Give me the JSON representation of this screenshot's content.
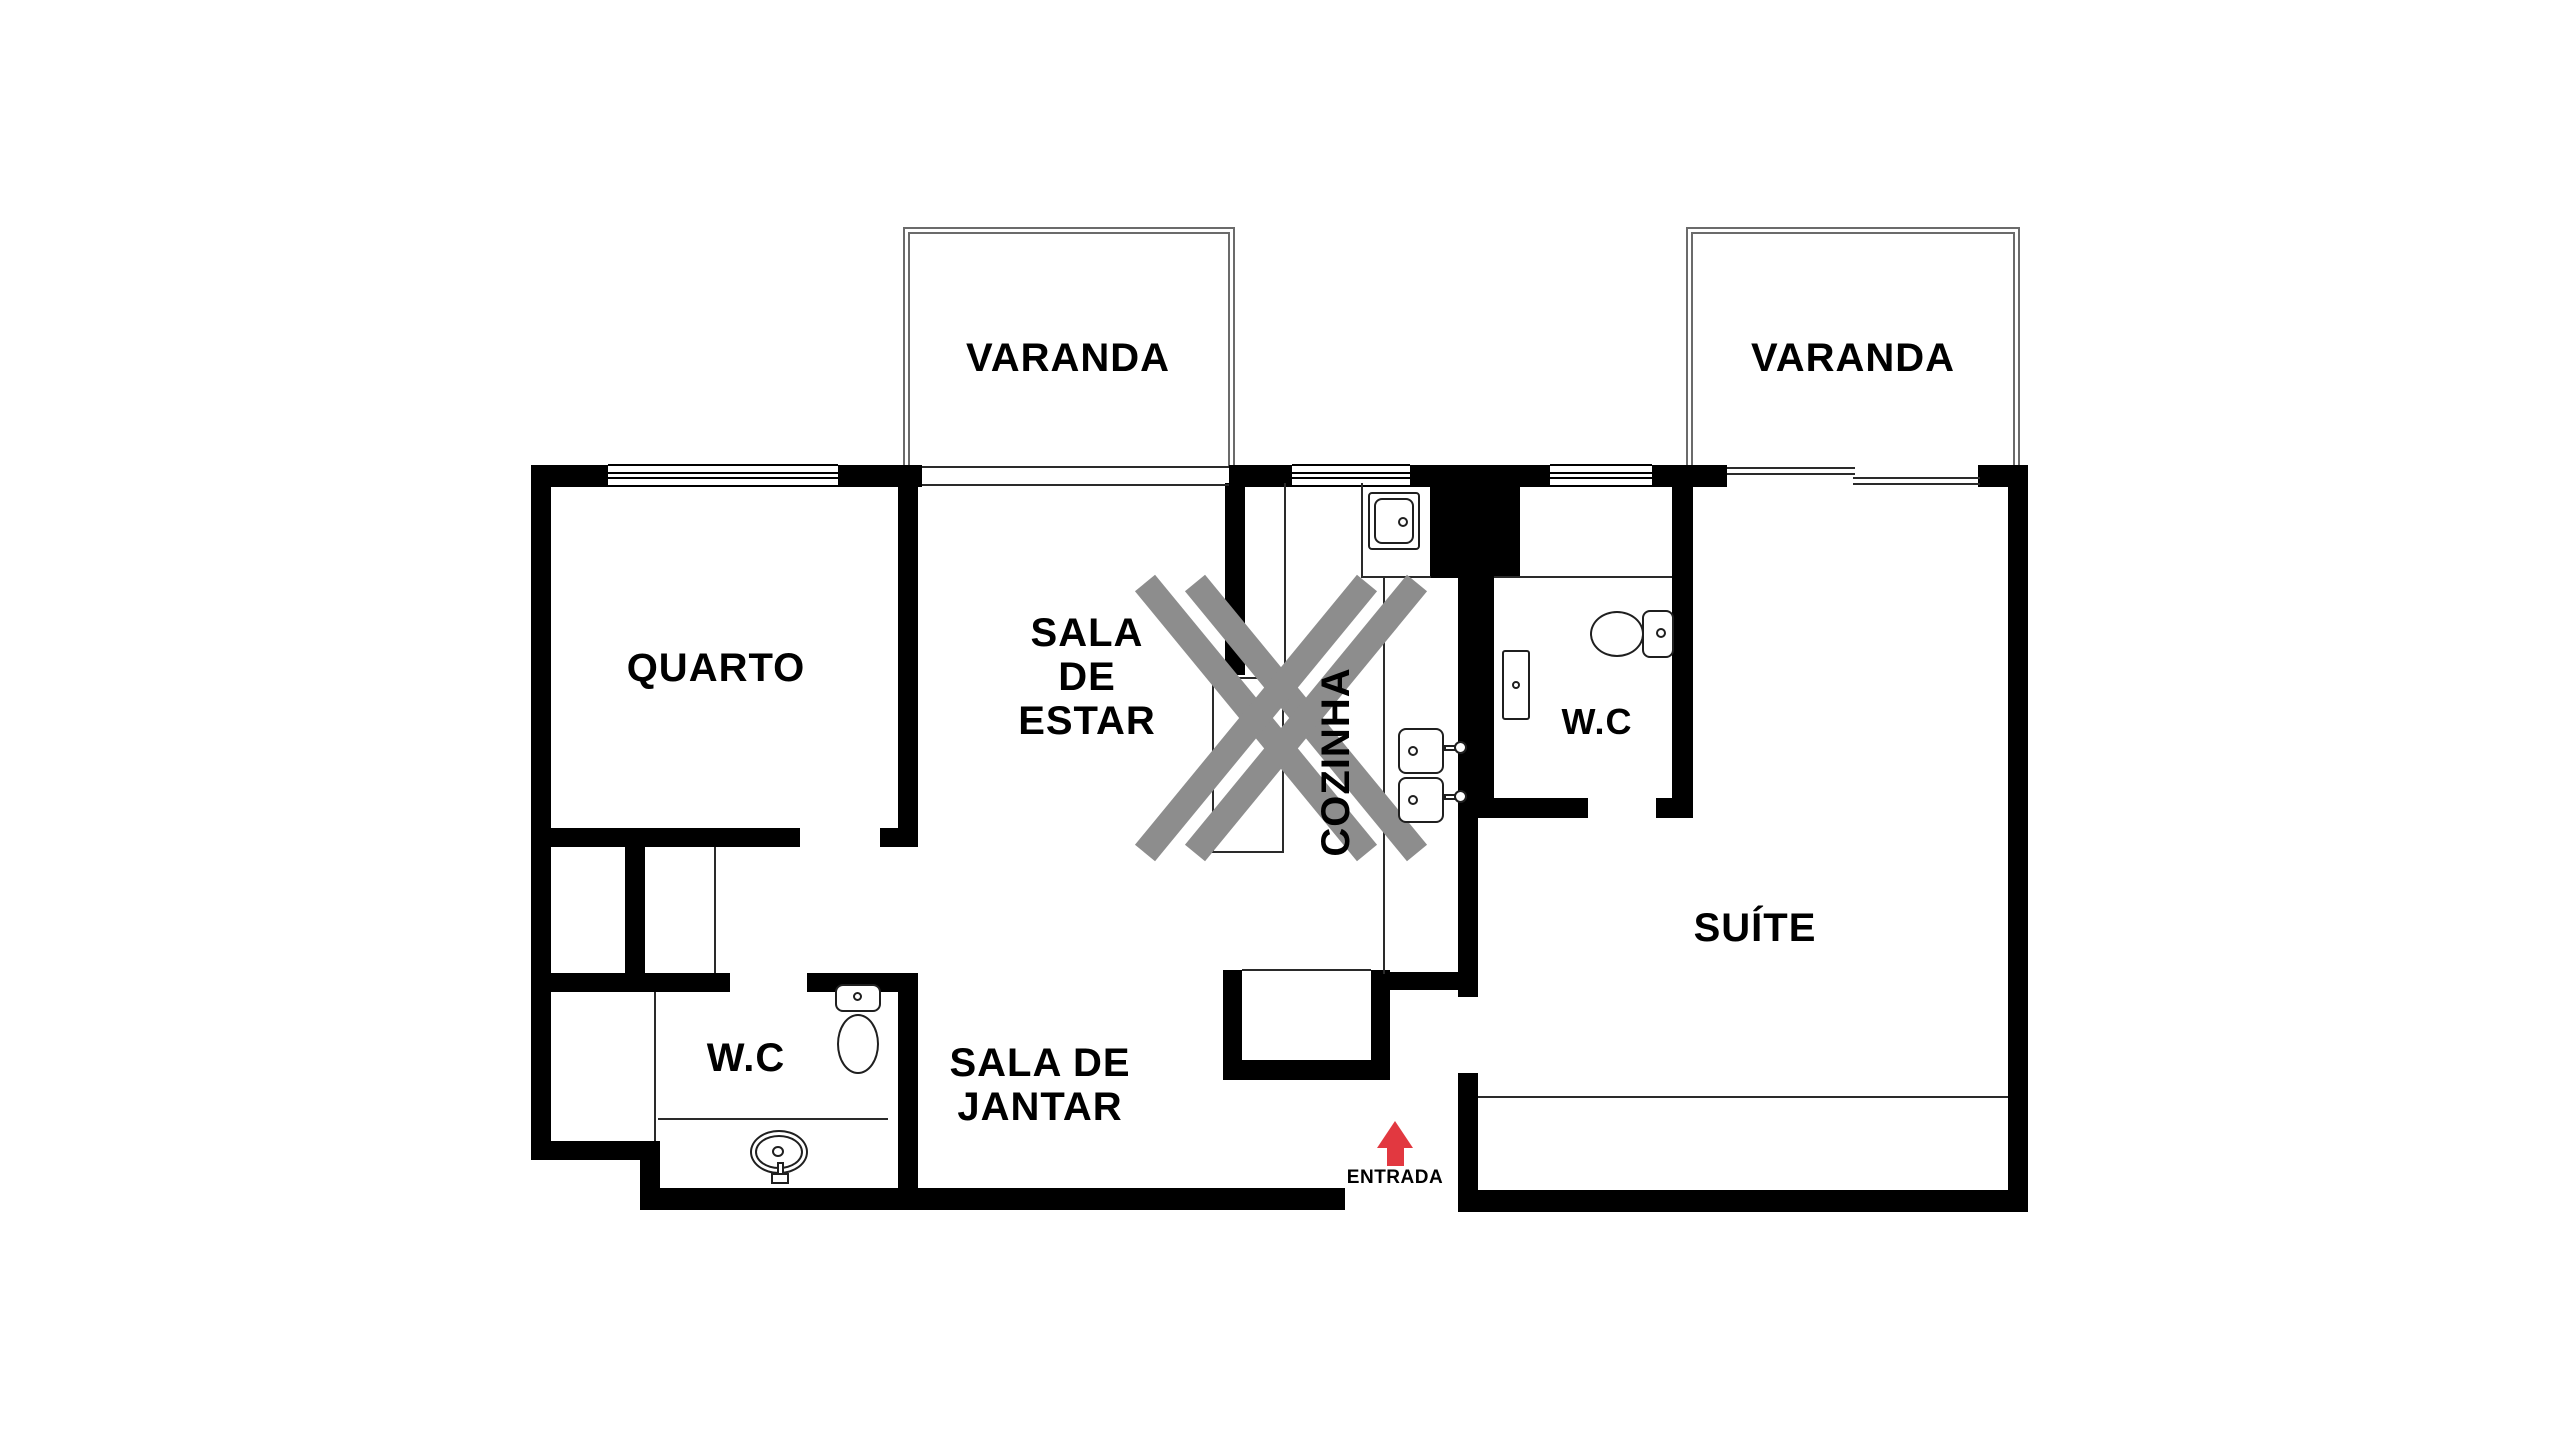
{
  "title": "Planta de apartamento",
  "colors": {
    "wall": "#000000",
    "thin_line": "#2a2a2a",
    "balcony_line": "#6b6b6b",
    "demolition_gray": "#8d8d8d",
    "entrance_red": "#e23840",
    "fixture_line": "#1f1f1f",
    "background": "#ffffff",
    "text": "#000000"
  },
  "rooms": {
    "varanda_left": {
      "label": "VARANDA"
    },
    "varanda_right": {
      "label": "VARANDA"
    },
    "quarto": {
      "label": "QUARTO"
    },
    "sala_de_estar": {
      "line1": "SALA",
      "line2": "DE",
      "line3": "ESTAR"
    },
    "cozinha": {
      "label": "COZINHA"
    },
    "wc_social": {
      "label": "W.C"
    },
    "wc_suite": {
      "label": "W.C"
    },
    "suite": {
      "label": "SUÍTE"
    },
    "sala_de_jantar": {
      "line1": "SALA DE",
      "line2": "JANTAR"
    }
  },
  "entrance": {
    "label": "ENTRADA"
  },
  "icons": {
    "demolition_marker": "double-x-demolition-marker",
    "entrance_arrow": "red-arrow-up"
  }
}
